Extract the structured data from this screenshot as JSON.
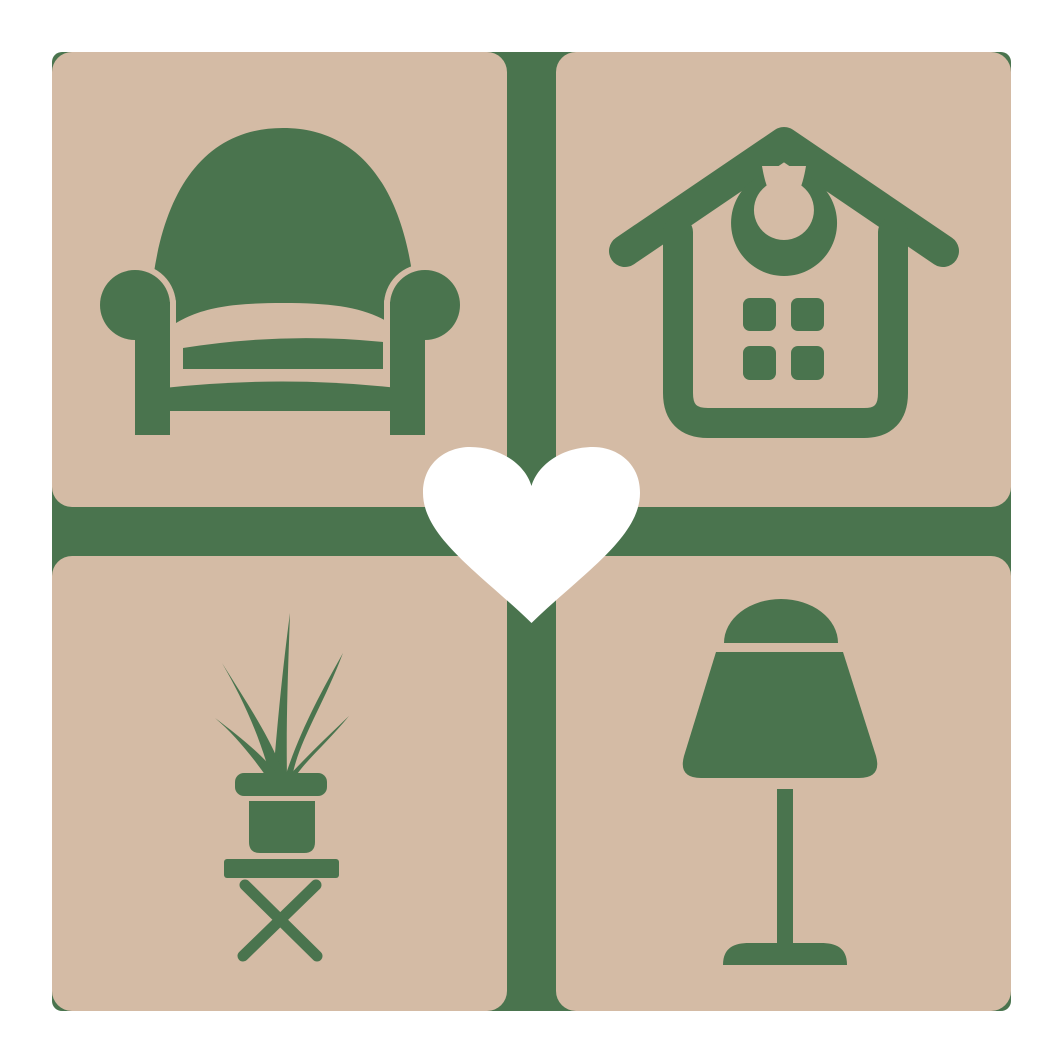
{
  "logo": {
    "kind": "home-decor-logo",
    "grid": {
      "rows": 2,
      "cols": 2
    },
    "tiles": [
      {
        "position": "top-left",
        "icon": "armchair"
      },
      {
        "position": "top-right",
        "icon": "house"
      },
      {
        "position": "bottom-left",
        "icon": "potted-plant-on-stool"
      },
      {
        "position": "bottom-right",
        "icon": "table-lamp"
      }
    ],
    "center_icon": "heart"
  },
  "colors": {
    "green": "#4a744e",
    "beige": "#d4bba5",
    "white": "#ffffff"
  }
}
